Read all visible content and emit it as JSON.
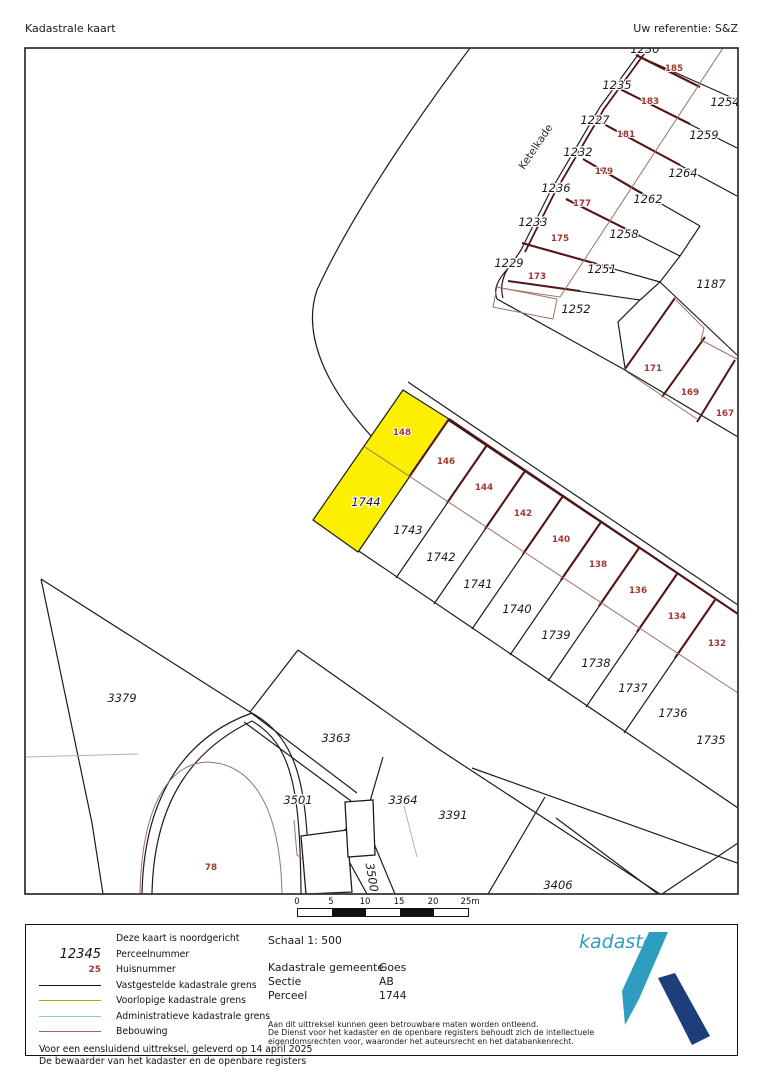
{
  "header": {
    "title": "Kadastrale kaart",
    "reference": "Uw referentie: S&Z"
  },
  "map": {
    "street_label": "Ketelkade",
    "highlighted_parcel": "1744",
    "colors": {
      "highlight_fill": "#fcf000",
      "parcel_boundary": "#1c1c1c",
      "building_line": "#9b7264",
      "party_wall": "#541515",
      "house_number": "#a03a34",
      "admin_gray": "#b3b3b3"
    },
    "labels": [
      {
        "t": "1230",
        "x": 645,
        "y": 53,
        "k": "p"
      },
      {
        "t": "1235",
        "x": 617,
        "y": 89,
        "k": "p"
      },
      {
        "t": "1227",
        "x": 595,
        "y": 124,
        "k": "p"
      },
      {
        "t": "1232",
        "x": 578,
        "y": 156,
        "k": "p"
      },
      {
        "t": "1236",
        "x": 556,
        "y": 192,
        "k": "p"
      },
      {
        "t": "1233",
        "x": 533,
        "y": 226,
        "k": "p"
      },
      {
        "t": "1229",
        "x": 509,
        "y": 267,
        "k": "p"
      },
      {
        "t": "1254",
        "x": 725,
        "y": 106,
        "k": "p"
      },
      {
        "t": "1259",
        "x": 704,
        "y": 139,
        "k": "p"
      },
      {
        "t": "1264",
        "x": 683,
        "y": 177,
        "k": "p"
      },
      {
        "t": "1262",
        "x": 648,
        "y": 203,
        "k": "p"
      },
      {
        "t": "1258",
        "x": 624,
        "y": 238,
        "k": "p"
      },
      {
        "t": "1251",
        "x": 602,
        "y": 273,
        "k": "p"
      },
      {
        "t": "1252",
        "x": 576,
        "y": 313,
        "k": "p"
      },
      {
        "t": "1187",
        "x": 711,
        "y": 288,
        "k": "p"
      },
      {
        "t": "1744",
        "x": 366,
        "y": 506,
        "k": "p"
      },
      {
        "t": "1743",
        "x": 408,
        "y": 534,
        "k": "p"
      },
      {
        "t": "1742",
        "x": 441,
        "y": 561,
        "k": "p"
      },
      {
        "t": "1741",
        "x": 478,
        "y": 588,
        "k": "p"
      },
      {
        "t": "1740",
        "x": 517,
        "y": 613,
        "k": "p"
      },
      {
        "t": "1739",
        "x": 556,
        "y": 639,
        "k": "p"
      },
      {
        "t": "1738",
        "x": 596,
        "y": 667,
        "k": "p"
      },
      {
        "t": "1737",
        "x": 633,
        "y": 692,
        "k": "p"
      },
      {
        "t": "1736",
        "x": 673,
        "y": 717,
        "k": "p"
      },
      {
        "t": "1735",
        "x": 711,
        "y": 744,
        "k": "p"
      },
      {
        "t": "3379",
        "x": 122,
        "y": 702,
        "k": "p"
      },
      {
        "t": "3363",
        "x": 336,
        "y": 742,
        "k": "p"
      },
      {
        "t": "3501",
        "x": 298,
        "y": 804,
        "k": "p"
      },
      {
        "t": "3364",
        "x": 403,
        "y": 804,
        "k": "p"
      },
      {
        "t": "3391",
        "x": 453,
        "y": 819,
        "k": "p"
      },
      {
        "t": "3406",
        "x": 558,
        "y": 889,
        "k": "p"
      },
      {
        "t": "3500",
        "x": 368,
        "y": 878,
        "k": "p",
        "r": 80
      },
      {
        "t": "185",
        "x": 674,
        "y": 71,
        "k": "h"
      },
      {
        "t": "183",
        "x": 650,
        "y": 104,
        "k": "h"
      },
      {
        "t": "181",
        "x": 626,
        "y": 137,
        "k": "h"
      },
      {
        "t": "179",
        "x": 604,
        "y": 174,
        "k": "h"
      },
      {
        "t": "177",
        "x": 582,
        "y": 206,
        "k": "h"
      },
      {
        "t": "175",
        "x": 560,
        "y": 241,
        "k": "h"
      },
      {
        "t": "173",
        "x": 537,
        "y": 279,
        "k": "h"
      },
      {
        "t": "171",
        "x": 653,
        "y": 371,
        "k": "h"
      },
      {
        "t": "169",
        "x": 690,
        "y": 395,
        "k": "h"
      },
      {
        "t": "167",
        "x": 725,
        "y": 416,
        "k": "h"
      },
      {
        "t": "148",
        "x": 402,
        "y": 435,
        "k": "h"
      },
      {
        "t": "146",
        "x": 446,
        "y": 464,
        "k": "h"
      },
      {
        "t": "144",
        "x": 484,
        "y": 490,
        "k": "h"
      },
      {
        "t": "142",
        "x": 523,
        "y": 516,
        "k": "h"
      },
      {
        "t": "140",
        "x": 561,
        "y": 542,
        "k": "h"
      },
      {
        "t": "138",
        "x": 598,
        "y": 567,
        "k": "h"
      },
      {
        "t": "136",
        "x": 638,
        "y": 593,
        "k": "h"
      },
      {
        "t": "134",
        "x": 677,
        "y": 619,
        "k": "h"
      },
      {
        "t": "132",
        "x": 717,
        "y": 646,
        "k": "h"
      },
      {
        "t": "78",
        "x": 211,
        "y": 870,
        "k": "h"
      }
    ]
  },
  "scalebar": {
    "ticks": [
      "0",
      "5",
      "10",
      "15",
      "20",
      "25m"
    ]
  },
  "legend": {
    "north_note": "Deze kaart is noordgericht",
    "parcel_sample": "12345",
    "parcel_label": "Perceelnummer",
    "house_sample": "25",
    "house_label": "Huisnummer",
    "line_fixed": "Vastgestelde kadastrale grens",
    "line_provisional": "Voorlopige kadastrale grens",
    "line_admin": "Administratieve kadastrale grens",
    "line_building": "Bebouwing",
    "issued_line1": "Voor een eensluidend uittreksel, geleverd op 14 april 2025",
    "issued_line2": "De bewaarder van het kadaster en de openbare registers",
    "colors": {
      "fixed": "#111111",
      "provisional": "#b3a41e",
      "admin": "#7fd2cc",
      "building": "#97675b"
    }
  },
  "info": {
    "scale": "Schaal 1: 500",
    "rows": [
      {
        "label": "Kadastrale gemeente",
        "value": "Goes"
      },
      {
        "label": "Sectie",
        "value": "AB"
      },
      {
        "label": "Perceel",
        "value": "1744"
      }
    ],
    "disclaimer1": "Aan dit uittreksel kunnen geen betrouwbare maten worden ontleend.",
    "disclaimer2": "De Dienst voor het kadaster en de openbare registers behoudt zich de intellectuele",
    "disclaimer3": "eigendomsrechten voor, waaronder het auteursrecht en het databankenrecht."
  },
  "logo": {
    "text": "kadaster",
    "teal": "#2e9dbf",
    "navy": "#1d3d7b"
  }
}
